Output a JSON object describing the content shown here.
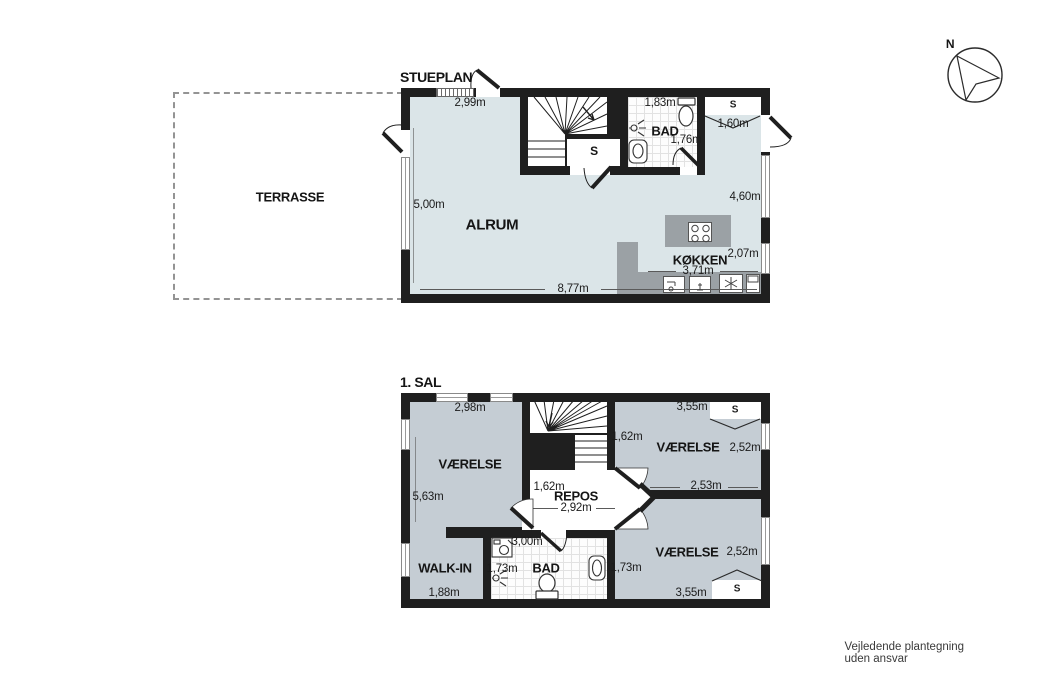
{
  "meta": {
    "compass_label": "N",
    "footer": "Vejledende plantegning uden ansvar"
  },
  "colors": {
    "wall": "#1f1f1f",
    "floor_ground": "#dbe5e8",
    "floor_upper": "#c5cdd4",
    "counter_gray": "#9ba1a5"
  },
  "stueplan": {
    "title": "STUEPLAN",
    "terrace_label": "TERRASSE",
    "rooms": {
      "alrum": "ALRUM",
      "bad": "BAD",
      "kokken": "KØKKEN",
      "closet_mid": "S",
      "closet_right": "S"
    },
    "dims": {
      "width_top": "2,99m",
      "depth_left": "5,00m",
      "width_bottom": "8,77m",
      "depth_right": "4,60m",
      "bad_width": "1,83m",
      "bad_depth": "1,76m",
      "closet_width": "1,60m",
      "kitchen_width": "3,71m",
      "kitchen_depth": "2,07m"
    }
  },
  "sal": {
    "title": "1. SAL",
    "rooms": {
      "room_nw": "VÆRELSE",
      "room_ne": "VÆRELSE",
      "room_se": "VÆRELSE",
      "repos": "REPOS",
      "walkin": "WALK-IN",
      "bad": "BAD",
      "closet_ne": "S",
      "closet_se": "S"
    },
    "dims": {
      "nw_width": "2,98m",
      "left_depth": "5,63m",
      "stair_width": "1,62m",
      "ne_width": "3,55m",
      "ne_depth": "2,52m",
      "ne_bottom": "2,53m",
      "repos_left": "1,62m",
      "repos_width": "2,92m",
      "walkin_width": "1,88m",
      "bad_width": "3,00m",
      "bad_depth": "1,73m",
      "se_left": "1,73m",
      "se_depth": "2,52m",
      "se_width": "3,55m"
    }
  }
}
